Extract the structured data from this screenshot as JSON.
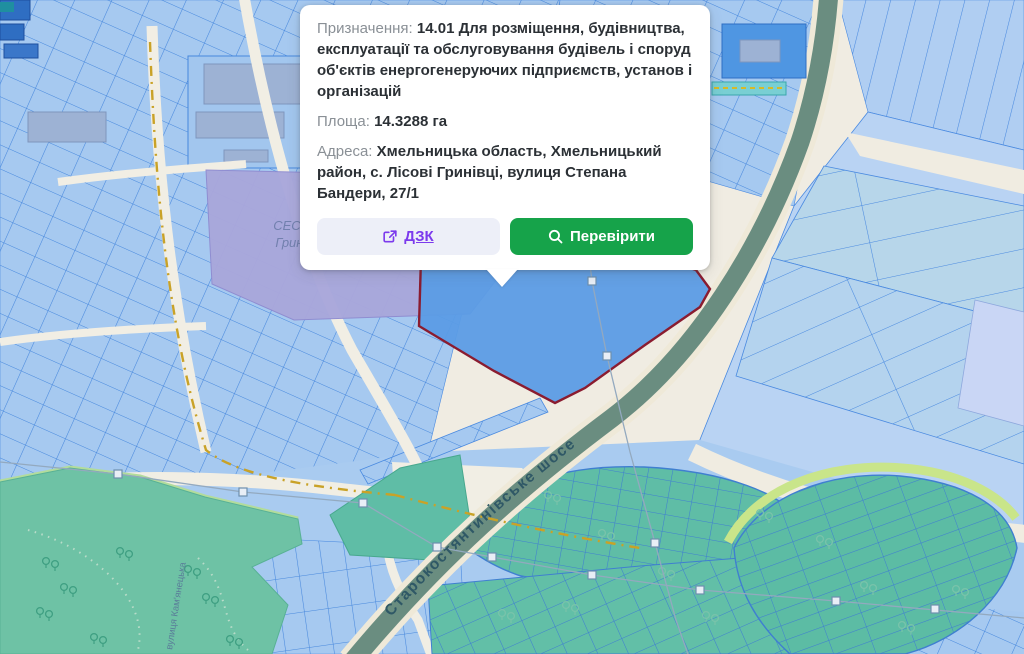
{
  "popup": {
    "purpose_label": "Призначення:",
    "purpose_value": "14.01 Для розміщення, будівництва, експлуатації та обслуговування будівель і споруд об'єктів енергогенеруючих підприємств, установ і організацій",
    "area_label": "Площа:",
    "area_value": "14.3288 га",
    "address_label": "Адреса:",
    "address_value": "Хмельницька область, Хмельницький район, с. Лісові Гринівці, вулиця Степана Бандери, 27/1",
    "buttons": {
      "dzk": "ДЗК",
      "verify": "Перевірити"
    }
  },
  "map": {
    "ses_label_line1": "СЕС «Лісові",
    "ses_label_line2": "Гринівці»",
    "road_label": "Старокостянтинівське шосе",
    "street_label": "вулиця Кам'янецька",
    "colors": {
      "selected_parcel_fill": "#5b9ce5",
      "selected_parcel_border": "#8a1c30",
      "parcel_blue": "#a6c9f0",
      "parcel_outline": "#4788dd",
      "ses_zone_purple": "#a9a7db",
      "road_sage": "#6a8d80",
      "park_green": "#6ec2a5",
      "garden_green": "#5fbda6",
      "background_beige": "#f0ece2",
      "accent_green": "#16a34a",
      "link_purple": "#7c3aed"
    }
  }
}
